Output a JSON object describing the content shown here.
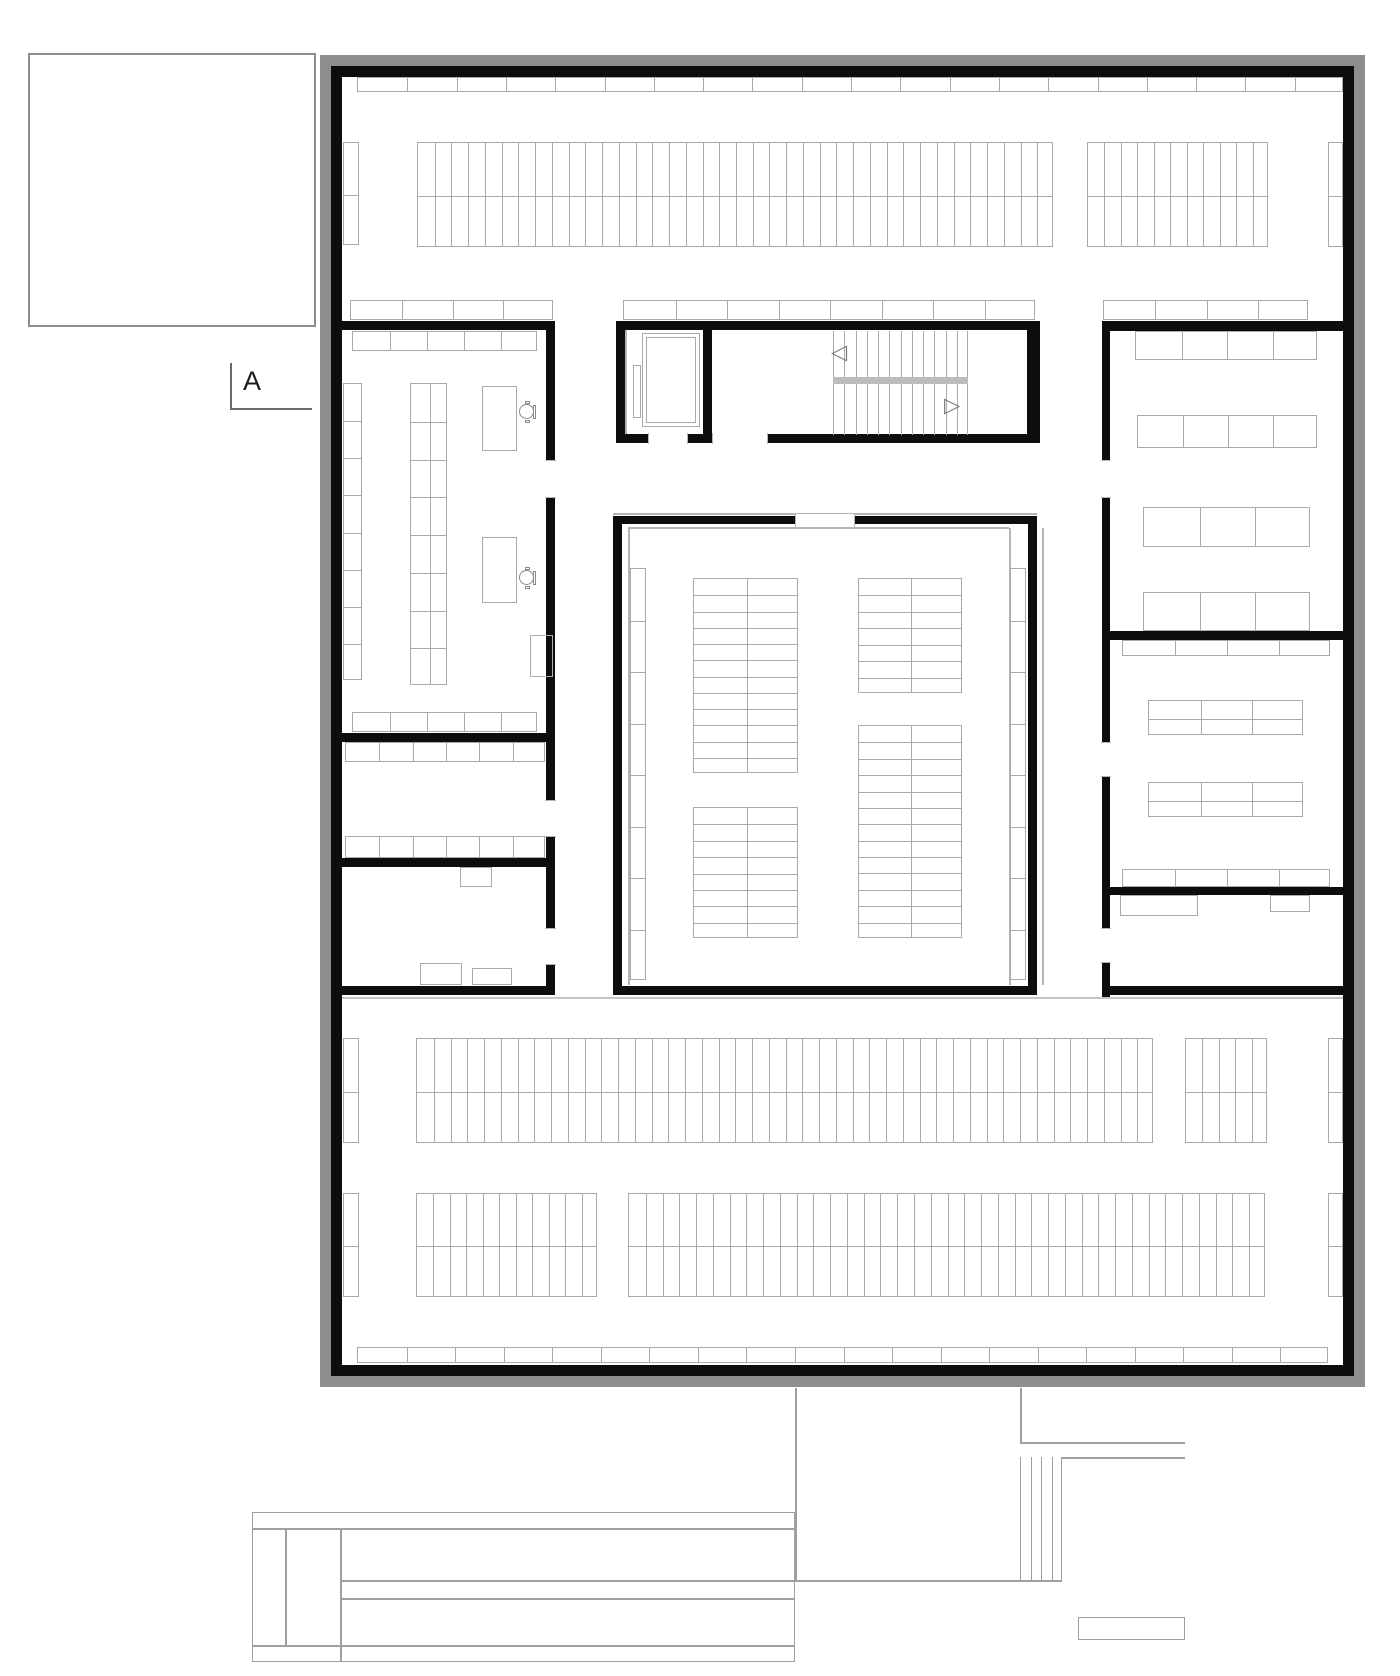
{
  "section_marker": {
    "label": "A"
  },
  "colors": {
    "wall_black": "#0d0d0d",
    "frame_gray": "#8e8e8e",
    "furniture_line": "#a9a9a9",
    "light_line": "#b5b5b5",
    "corridor_line": "#c6c6c6",
    "site_line": "#9f9f9f",
    "landing_gray": "#bcbcbc",
    "chair_line": "#8a8a8a",
    "marker_line": "#6a6a6a",
    "paper": "#ffffff"
  },
  "icons": {
    "stair_up_arrow": "◁",
    "stair_down_arrow": "▷"
  },
  "plan": {
    "frames": [
      {
        "name": "outer-gray-frame",
        "x": 320,
        "y": 55,
        "w": 1045,
        "h": 1332,
        "t": 11,
        "color": "frame_gray"
      },
      {
        "name": "outer-black-wall",
        "x": 331,
        "y": 66,
        "w": 1023,
        "h": 1310,
        "t": 11,
        "color": "wall_black"
      }
    ],
    "context_rects": [
      {
        "name": "context-rect-topleft",
        "x": 28,
        "y": 53,
        "w": 288,
        "h": 274,
        "color": "frame_gray"
      }
    ],
    "walls": [
      {
        "name": "leftblock-top-wall",
        "x": 342,
        "y": 321,
        "w": 213,
        "h": 9
      },
      {
        "name": "leftblock-right-wall",
        "x": 546,
        "y": 321,
        "w": 9,
        "h": 674
      },
      {
        "name": "leftblock-divider1",
        "x": 342,
        "y": 733,
        "w": 204,
        "h": 9
      },
      {
        "name": "leftblock-divider2",
        "x": 342,
        "y": 858,
        "w": 204,
        "h": 9
      },
      {
        "name": "leftblock-bottom-wall",
        "x": 342,
        "y": 986,
        "w": 213,
        "h": 9
      },
      {
        "name": "core-top-wall",
        "x": 616,
        "y": 321,
        "w": 424,
        "h": 9
      },
      {
        "name": "core-left-wall",
        "x": 616,
        "y": 321,
        "w": 9,
        "h": 122
      },
      {
        "name": "core-divider-wall",
        "x": 703,
        "y": 321,
        "w": 9,
        "h": 122
      },
      {
        "name": "core-right-wall",
        "x": 1027,
        "y": 321,
        "w": 13,
        "h": 122
      },
      {
        "name": "core-bottom-wall",
        "x": 616,
        "y": 434,
        "w": 424,
        "h": 9
      },
      {
        "name": "hall-top-wall",
        "x": 613,
        "y": 516,
        "w": 424,
        "h": 8
      },
      {
        "name": "hall-left-wall",
        "x": 613,
        "y": 516,
        "w": 9,
        "h": 479
      },
      {
        "name": "hall-right-wall",
        "x": 1028,
        "y": 516,
        "w": 9,
        "h": 479
      },
      {
        "name": "hall-bottom-wall",
        "x": 613,
        "y": 986,
        "w": 424,
        "h": 9
      },
      {
        "name": "rightblock-top-wall",
        "x": 1102,
        "y": 321,
        "w": 252,
        "h": 10
      },
      {
        "name": "rightblock-left-wall",
        "x": 1102,
        "y": 321,
        "w": 8,
        "h": 676
      },
      {
        "name": "rightblock-divider1",
        "x": 1102,
        "y": 631,
        "w": 252,
        "h": 9
      },
      {
        "name": "rightblock-divider2",
        "x": 1102,
        "y": 887,
        "w": 252,
        "h": 8
      },
      {
        "name": "rightblock-bottom-wall",
        "x": 1102,
        "y": 986,
        "w": 252,
        "h": 9
      }
    ],
    "doors": [
      {
        "name": "elevator-door-opening",
        "x": 648,
        "y": 433,
        "w": 40,
        "h": 11,
        "o": "h"
      },
      {
        "name": "stair-door-opening",
        "x": 712,
        "y": 433,
        "w": 56,
        "h": 11,
        "o": "h"
      },
      {
        "name": "leftroom-door-opening",
        "x": 545,
        "y": 460,
        "w": 11,
        "h": 38,
        "o": "v"
      },
      {
        "name": "midroom-door-opening",
        "x": 545,
        "y": 800,
        "w": 11,
        "h": 37,
        "o": "v"
      },
      {
        "name": "bottomroom-door-opening",
        "x": 545,
        "y": 928,
        "w": 11,
        "h": 37,
        "o": "v"
      },
      {
        "name": "rightroom1-door-opening",
        "x": 1101,
        "y": 460,
        "w": 10,
        "h": 38,
        "o": "v"
      },
      {
        "name": "rightroom2-door-opening",
        "x": 1101,
        "y": 742,
        "w": 10,
        "h": 35,
        "o": "v"
      },
      {
        "name": "rightroom3-door-opening",
        "x": 1101,
        "y": 928,
        "w": 10,
        "h": 35,
        "o": "v"
      }
    ],
    "lines": [
      {
        "name": "hall-top-outer-line",
        "o": "h",
        "x": 613,
        "y": 513,
        "len": 424,
        "color": "light_line"
      },
      {
        "name": "hall-inner-top-line",
        "o": "h",
        "x": 628,
        "y": 527,
        "len": 381,
        "color": "light_line"
      },
      {
        "name": "hall-inner-left-line",
        "o": "v",
        "x": 628,
        "y": 528,
        "len": 457,
        "color": "light_line"
      },
      {
        "name": "hall-inner-right-line",
        "o": "v",
        "x": 1009,
        "y": 528,
        "len": 457,
        "color": "light_line"
      },
      {
        "name": "hall-outer-right-line",
        "o": "v",
        "x": 1042,
        "y": 528,
        "len": 457,
        "color": "light_line"
      },
      {
        "name": "corridor-floor-line",
        "o": "h",
        "x": 342,
        "y": 997,
        "len": 1001,
        "color": "corridor_line"
      },
      {
        "name": "elevator-inner-line",
        "o": "v",
        "x": 625,
        "y": 330,
        "len": 104,
        "color": "light_line"
      },
      {
        "name": "section-marker-vline",
        "o": "v",
        "x": 230,
        "y": 363,
        "len": 46,
        "color": "marker_line"
      },
      {
        "name": "section-marker-hline",
        "o": "h",
        "x": 230,
        "y": 408,
        "len": 82,
        "color": "marker_line"
      },
      {
        "name": "site-underpass-left-line",
        "o": "v",
        "x": 795,
        "y": 1388,
        "len": 192,
        "color": "site_line"
      },
      {
        "name": "site-underpass-right-line",
        "o": "v",
        "x": 1020,
        "y": 1388,
        "len": 54,
        "color": "site_line"
      },
      {
        "name": "site-terrace-top-line",
        "o": "h",
        "x": 1020,
        "y": 1442,
        "len": 165,
        "color": "site_line"
      },
      {
        "name": "site-terrace-second-line",
        "o": "h",
        "x": 1062,
        "y": 1457,
        "len": 123,
        "color": "site_line"
      },
      {
        "name": "site-long-line",
        "o": "h",
        "x": 340,
        "y": 1580,
        "len": 722,
        "color": "site_line"
      },
      {
        "name": "site-bar-line-upper",
        "o": "h",
        "x": 252,
        "y": 1528,
        "len": 543,
        "color": "site_line"
      },
      {
        "name": "site-bar-line-lower",
        "o": "h",
        "x": 252,
        "y": 1645,
        "len": 543,
        "color": "site_line"
      },
      {
        "name": "site-bar-vline1",
        "o": "v",
        "x": 285,
        "y": 1528,
        "len": 117,
        "color": "site_line"
      },
      {
        "name": "site-bar-vline2",
        "o": "v",
        "x": 340,
        "y": 1528,
        "len": 134,
        "color": "site_line"
      },
      {
        "name": "site-bar-inner-line",
        "o": "h",
        "x": 340,
        "y": 1598,
        "len": 455,
        "color": "site_line"
      }
    ],
    "grids": [
      {
        "name": "top-wall-shelf-row",
        "x": 357,
        "y": 77,
        "w": 986,
        "h": 15,
        "cols": 20,
        "rows": 1
      },
      {
        "name": "stacks-top-left-strip",
        "x": 343,
        "y": 142,
        "w": 16,
        "h": 103,
        "cols": 1,
        "rows": 2
      },
      {
        "name": "stacks-top-main",
        "x": 417,
        "y": 142,
        "w": 636,
        "h": 105,
        "cols": 38,
        "rows": 2
      },
      {
        "name": "stacks-top-right-group",
        "x": 1087,
        "y": 142,
        "w": 181,
        "h": 105,
        "cols": 11,
        "rows": 2
      },
      {
        "name": "stacks-top-right-strip",
        "x": 1328,
        "y": 142,
        "w": 15,
        "h": 105,
        "cols": 1,
        "rows": 2
      },
      {
        "name": "shelf-row-left-core",
        "x": 350,
        "y": 300,
        "w": 203,
        "h": 20,
        "cols": 4,
        "rows": 1
      },
      {
        "name": "shelf-row-mid-core",
        "x": 623,
        "y": 300,
        "w": 412,
        "h": 20,
        "cols": 8,
        "rows": 1
      },
      {
        "name": "shelf-row-right-core",
        "x": 1103,
        "y": 300,
        "w": 205,
        "h": 20,
        "cols": 4,
        "rows": 1
      },
      {
        "name": "readingroom-shelf-top",
        "x": 352,
        "y": 331,
        "w": 185,
        "h": 20,
        "cols": 5,
        "rows": 1
      },
      {
        "name": "readingroom-table-strip-left",
        "x": 343,
        "y": 383,
        "w": 19,
        "h": 297,
        "cols": 1,
        "rows": 8
      },
      {
        "name": "readingroom-table-strip-mid",
        "x": 410,
        "y": 383,
        "w": 37,
        "h": 302,
        "cols": 2,
        "rows": 8
      },
      {
        "name": "readingroom-shelf-bottom",
        "x": 352,
        "y": 712,
        "w": 185,
        "h": 20,
        "cols": 5,
        "rows": 1
      },
      {
        "name": "midroom-shelf-top",
        "x": 345,
        "y": 742,
        "w": 200,
        "h": 20,
        "cols": 6,
        "rows": 1
      },
      {
        "name": "midroom-shelf-bottom",
        "x": 345,
        "y": 836,
        "w": 200,
        "h": 22,
        "cols": 6,
        "rows": 1
      },
      {
        "name": "stair-upper-treads",
        "x": 833,
        "y": 331,
        "w": 135,
        "h": 46,
        "cols": 12,
        "rows": 1,
        "outline": false,
        "ends": true
      },
      {
        "name": "stair-lower-treads",
        "x": 833,
        "y": 384,
        "w": 135,
        "h": 51,
        "cols": 12,
        "rows": 1,
        "outline": false,
        "ends": true
      },
      {
        "name": "hall-wall-strip-left",
        "x": 630,
        "y": 568,
        "w": 16,
        "h": 412,
        "cols": 1,
        "rows": 8
      },
      {
        "name": "hall-wall-strip-right",
        "x": 1010,
        "y": 568,
        "w": 16,
        "h": 412,
        "cols": 1,
        "rows": 8
      },
      {
        "name": "hall-table-group-1",
        "x": 693,
        "y": 578,
        "w": 105,
        "h": 195,
        "cols": 2,
        "rows": 12
      },
      {
        "name": "hall-table-group-2",
        "x": 858,
        "y": 578,
        "w": 104,
        "h": 115,
        "cols": 2,
        "rows": 7
      },
      {
        "name": "hall-table-group-3",
        "x": 693,
        "y": 807,
        "w": 105,
        "h": 131,
        "cols": 2,
        "rows": 8
      },
      {
        "name": "hall-table-group-4",
        "x": 858,
        "y": 725,
        "w": 104,
        "h": 213,
        "cols": 2,
        "rows": 13
      },
      {
        "name": "rightroom1-table-row1",
        "x": 1135,
        "y": 331,
        "w": 182,
        "h": 29,
        "cols": 4,
        "rows": 1
      },
      {
        "name": "rightroom1-table-row2",
        "x": 1137,
        "y": 415,
        "w": 180,
        "h": 33,
        "cols": 4,
        "rows": 1
      },
      {
        "name": "rightroom1-table-row3",
        "x": 1143,
        "y": 507,
        "w": 167,
        "h": 40,
        "cols": 3,
        "rows": 1
      },
      {
        "name": "rightroom1-table-row4",
        "x": 1143,
        "y": 592,
        "w": 167,
        "h": 39,
        "cols": 3,
        "rows": 1
      },
      {
        "name": "rightroom2-shelf-top",
        "x": 1122,
        "y": 640,
        "w": 208,
        "h": 16,
        "cols": 4,
        "rows": 1
      },
      {
        "name": "rightroom2-table-grid1",
        "x": 1148,
        "y": 700,
        "w": 155,
        "h": 35,
        "cols": 3,
        "rows": 2
      },
      {
        "name": "rightroom2-table-grid2",
        "x": 1148,
        "y": 782,
        "w": 155,
        "h": 35,
        "cols": 3,
        "rows": 2
      },
      {
        "name": "rightroom2-shelf-bottom",
        "x": 1122,
        "y": 869,
        "w": 208,
        "h": 18,
        "cols": 4,
        "rows": 1
      },
      {
        "name": "stacks-a-left-strip",
        "x": 343,
        "y": 1038,
        "w": 16,
        "h": 105,
        "cols": 1,
        "rows": 2
      },
      {
        "name": "stacks-a-main",
        "x": 416,
        "y": 1038,
        "w": 737,
        "h": 105,
        "cols": 44,
        "rows": 2
      },
      {
        "name": "stacks-a-right-group",
        "x": 1185,
        "y": 1038,
        "w": 82,
        "h": 105,
        "cols": 5,
        "rows": 2
      },
      {
        "name": "stacks-a-right-strip",
        "x": 1328,
        "y": 1038,
        "w": 15,
        "h": 105,
        "cols": 1,
        "rows": 2
      },
      {
        "name": "stacks-b-left-strip",
        "x": 343,
        "y": 1193,
        "w": 16,
        "h": 104,
        "cols": 1,
        "rows": 2
      },
      {
        "name": "stacks-b-group1",
        "x": 416,
        "y": 1193,
        "w": 181,
        "h": 104,
        "cols": 11,
        "rows": 2
      },
      {
        "name": "stacks-b-group2",
        "x": 628,
        "y": 1193,
        "w": 637,
        "h": 104,
        "cols": 38,
        "rows": 2
      },
      {
        "name": "stacks-b-right-strip",
        "x": 1328,
        "y": 1193,
        "w": 15,
        "h": 104,
        "cols": 1,
        "rows": 2
      },
      {
        "name": "bottom-wall-shelf-row",
        "x": 357,
        "y": 1347,
        "w": 971,
        "h": 16,
        "cols": 20,
        "rows": 1
      },
      {
        "name": "site-stair-ladder",
        "x": 1020,
        "y": 1457,
        "w": 42,
        "h": 123,
        "cols": 4,
        "rows": 1,
        "outline": false,
        "ends": true,
        "color": "site_line"
      }
    ],
    "rects": [
      {
        "name": "stair-landing-bar",
        "x": 833,
        "y": 377,
        "w": 135,
        "h": 7,
        "fill": "landing_gray"
      },
      {
        "name": "elevator-car-outer",
        "x": 642,
        "y": 333,
        "w": 58,
        "h": 94
      },
      {
        "name": "elevator-car-inner",
        "x": 646,
        "y": 337,
        "w": 50,
        "h": 86
      },
      {
        "name": "elevator-door-panel",
        "x": 633,
        "y": 365,
        "w": 8,
        "h": 53
      },
      {
        "name": "readingroom-desk1",
        "x": 482,
        "y": 386,
        "w": 35,
        "h": 65
      },
      {
        "name": "readingroom-desk2",
        "x": 482,
        "y": 537,
        "w": 35,
        "h": 66
      },
      {
        "name": "readingroom-corner-shelf",
        "x": 530,
        "y": 635,
        "w": 23,
        "h": 42
      },
      {
        "name": "bottomroom-table",
        "x": 460,
        "y": 867,
        "w": 32,
        "h": 20
      },
      {
        "name": "bottomroom-rect1",
        "x": 420,
        "y": 963,
        "w": 42,
        "h": 22
      },
      {
        "name": "bottomroom-rect2",
        "x": 472,
        "y": 968,
        "w": 40,
        "h": 17
      },
      {
        "name": "rightroom3-counter",
        "x": 1120,
        "y": 895,
        "w": 78,
        "h": 21
      },
      {
        "name": "rightroom3-shelf",
        "x": 1270,
        "y": 895,
        "w": 40,
        "h": 17
      },
      {
        "name": "hall-entry-door-frame",
        "x": 795,
        "y": 513,
        "w": 60,
        "h": 15,
        "fill": "paper",
        "stroke": "light_line"
      },
      {
        "name": "site-bar-outline",
        "x": 252,
        "y": 1512,
        "w": 543,
        "h": 150,
        "stroke": "site_line"
      },
      {
        "name": "site-small-rect",
        "x": 1078,
        "y": 1617,
        "w": 107,
        "h": 23,
        "stroke": "site_line"
      }
    ],
    "chairs": [
      {
        "name": "readingroom-chair1",
        "cx": 527,
        "cy": 412
      },
      {
        "name": "readingroom-chair2",
        "cx": 527,
        "cy": 578
      }
    ],
    "arrows": [
      {
        "name": "stair-up-arrow-icon",
        "x": 831,
        "y": 342,
        "glyph": "stair_up_arrow"
      },
      {
        "name": "stair-down-arrow-icon",
        "x": 944,
        "y": 395,
        "glyph": "stair_down_arrow"
      }
    ]
  }
}
